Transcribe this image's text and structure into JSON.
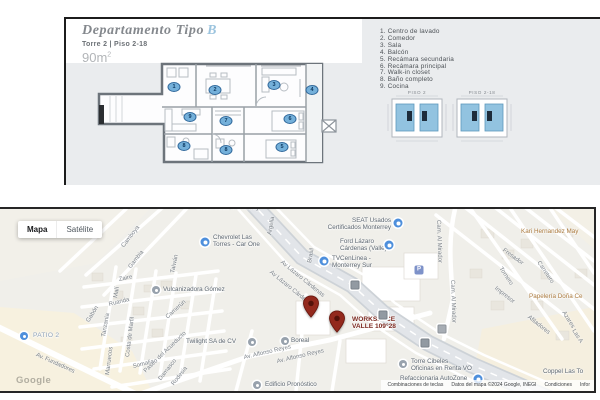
{
  "floorplan": {
    "title": "Departamento Tipo",
    "title_accent": "B",
    "subtitle": "Torre 2 | Piso 2-18",
    "area": "90m",
    "area_exp": "2",
    "legend": [
      "1. Centro de lavado",
      "2. Comedor",
      "3. Sala",
      "4. Balcón",
      "5. Recámara secundaria",
      "6. Recámara principal",
      "7. Walk-in closet",
      "8. Baño completo",
      "9. Cocina"
    ],
    "markers": [
      {
        "n": "1",
        "x": 108,
        "y": 68
      },
      {
        "n": "2",
        "x": 149,
        "y": 71
      },
      {
        "n": "3",
        "x": 208,
        "y": 66
      },
      {
        "n": "4",
        "x": 246,
        "y": 71
      },
      {
        "n": "9",
        "x": 124,
        "y": 98
      },
      {
        "n": "8",
        "x": 118,
        "y": 127
      },
      {
        "n": "7",
        "x": 160,
        "y": 102
      },
      {
        "n": "8",
        "x": 160,
        "y": 131
      },
      {
        "n": "6",
        "x": 224,
        "y": 100
      },
      {
        "n": "5",
        "x": 216,
        "y": 128
      }
    ],
    "piso_labels": [
      "PISO 2",
      "PISO 2-18"
    ]
  },
  "map": {
    "controls": [
      {
        "label": "Mapa",
        "active": true
      },
      {
        "label": "Satélite",
        "active": false
      }
    ],
    "watermark": "Google",
    "footer": [
      "Combinaciones de teclas",
      "Datos del mapa ©2024 Google, INEGI",
      "Condiciones",
      "Infor"
    ],
    "streets": [
      {
        "name": "Camboya",
        "x": 123,
        "y": 35,
        "rot": -52
      },
      {
        "name": "Gambia",
        "x": 130,
        "y": 56,
        "rot": -52
      },
      {
        "name": "Taiwán",
        "x": 173,
        "y": 61,
        "rot": -78
      },
      {
        "name": "Argelia",
        "x": 270,
        "y": 23,
        "rot": -80
      },
      {
        "name": "Brasil",
        "x": 310,
        "y": 51,
        "rot": -80
      },
      {
        "name": "Zaire",
        "x": 119,
        "y": 68,
        "rot": -12
      },
      {
        "name": "Malí",
        "x": 116,
        "y": 86,
        "rot": -80
      },
      {
        "name": "Ruanda",
        "x": 109,
        "y": 93,
        "rot": -14
      },
      {
        "name": "Gabón",
        "x": 88,
        "y": 110,
        "rot": -58
      },
      {
        "name": "Tanzania",
        "x": 104,
        "y": 125,
        "rot": -80
      },
      {
        "name": "Camerún",
        "x": 167,
        "y": 106,
        "rot": -42
      },
      {
        "name": "Costa de Marfil",
        "x": 128,
        "y": 145,
        "rot": -83
      },
      {
        "name": "Marruecos",
        "x": 108,
        "y": 163,
        "rot": -83
      },
      {
        "name": "Somalia",
        "x": 133,
        "y": 155,
        "rot": -14
      },
      {
        "name": "Damasco",
        "x": 160,
        "y": 168,
        "rot": -52
      },
      {
        "name": "Rodesia",
        "x": 173,
        "y": 173,
        "rot": -52
      },
      {
        "name": "Paseo del Acueducto",
        "x": 145,
        "y": 160,
        "rot": -44
      },
      {
        "name": "Av. Fundadores",
        "x": 36,
        "y": 143,
        "rot": 24
      },
      {
        "name": "Av. Alfonso Reyes",
        "x": 244,
        "y": 146,
        "rot": -13
      },
      {
        "name": "Av. Alfonso Reyes",
        "x": 277,
        "y": 150,
        "rot": -13
      },
      {
        "name": "Av Lázaro Cárdenas",
        "x": 281,
        "y": 50,
        "rot": 39
      },
      {
        "name": "Av Lázaro Cárdenas",
        "x": 270,
        "y": 60,
        "rot": 39
      },
      {
        "name": "Cam. Al Mirador",
        "x": 438,
        "y": 8,
        "rot": 88
      },
      {
        "name": "Cam. Al Mirador",
        "x": 452,
        "y": 68,
        "rot": 88
      },
      {
        "name": "Fresador",
        "x": 503,
        "y": 38,
        "rot": 36
      },
      {
        "name": "Tornero",
        "x": 500,
        "y": 56,
        "rot": 56
      },
      {
        "name": "Carretero",
        "x": 538,
        "y": 50,
        "rot": 56
      },
      {
        "name": "Impresor",
        "x": 495,
        "y": 76,
        "rot": 38
      },
      {
        "name": "Afiladores",
        "x": 528,
        "y": 105,
        "rot": 38
      },
      {
        "name": "Azares",
        "x": 563,
        "y": 100,
        "rot": 58
      },
      {
        "name": "Las A",
        "x": 573,
        "y": 118,
        "rot": 58
      }
    ],
    "poi_labels": [
      {
        "x": 213,
        "y": 26,
        "cls": "biz",
        "lines": [
          "Chevrolet Las",
          "Torres - Car One"
        ]
      },
      {
        "x": 391,
        "y": 9,
        "cls": "biz",
        "align": "right",
        "lines": [
          "SEAT Usados",
          "Certificados Monterrey"
        ]
      },
      {
        "x": 340,
        "y": 30,
        "cls": "biz",
        "lines": [
          "Ford Lázaro",
          "Cárdenas (Valle)"
        ]
      },
      {
        "x": 332,
        "y": 47,
        "cls": "biz",
        "lines": [
          "TVCenLinea -",
          "Monterrey Sur"
        ]
      },
      {
        "x": 521,
        "y": 20,
        "cls": "shop",
        "lines": [
          "Kari Hernandez May"
        ]
      },
      {
        "x": 529,
        "y": 85,
        "cls": "shop",
        "lines": [
          "Papelería Doña Ce"
        ]
      },
      {
        "x": 163,
        "y": 78,
        "cls": "biz",
        "lines": [
          "Vulcanizadora Gómez"
        ]
      },
      {
        "x": 33,
        "y": 124,
        "cls": "area",
        "lines": [
          "PATIO 2"
        ]
      },
      {
        "x": 186,
        "y": 130,
        "cls": "biz",
        "lines": [
          "Twilight SA de CV"
        ]
      },
      {
        "x": 291,
        "y": 129,
        "cls": "biz",
        "lines": [
          "Boreal"
        ]
      },
      {
        "x": 352,
        "y": 108,
        "cls": "maroon",
        "lines": [
          "WORKSPACE",
          "VALLE 109°28"
        ]
      },
      {
        "x": 411,
        "y": 150,
        "cls": "biz",
        "lines": [
          "Torre Cibeles",
          "Oficinas en Renta VO"
        ]
      },
      {
        "x": 400,
        "y": 167,
        "cls": "biz",
        "lines": [
          "Refaccionaria AutoZone"
        ]
      },
      {
        "x": 265,
        "y": 173,
        "cls": "biz",
        "lines": [
          "Edificio Pronóstico"
        ]
      },
      {
        "x": 543,
        "y": 160,
        "cls": "biz",
        "lines": [
          "Coppel Las To"
        ]
      },
      {
        "x": 196,
        "y": -4,
        "cls": "biz",
        "lines": [
          "Universidad Monterrey"
        ]
      }
    ],
    "icons": [
      {
        "x": 205,
        "y": 33,
        "k": "blue"
      },
      {
        "x": 398,
        "y": 14,
        "k": "blue"
      },
      {
        "x": 389,
        "y": 36,
        "k": "blue"
      },
      {
        "x": 324,
        "y": 52,
        "k": "blue"
      },
      {
        "x": 156,
        "y": 81,
        "k": "gray"
      },
      {
        "x": 24,
        "y": 127,
        "k": "blue-sm"
      },
      {
        "x": 252,
        "y": 133,
        "k": "gray"
      },
      {
        "x": 285,
        "y": 132,
        "k": "gray"
      },
      {
        "x": 403,
        "y": 155,
        "k": "gray"
      },
      {
        "x": 478,
        "y": 170,
        "k": "blue"
      },
      {
        "x": 257,
        "y": 176,
        "k": "gray"
      },
      {
        "x": 419,
        "y": 61,
        "k": "parking",
        "glyph": "P"
      },
      {
        "x": 355,
        "y": 76,
        "k": "shield"
      },
      {
        "x": 383,
        "y": 106,
        "k": "shield"
      },
      {
        "x": 425,
        "y": 134,
        "k": "shield"
      },
      {
        "x": 442,
        "y": 120,
        "k": "gray-sq"
      }
    ],
    "pins": [
      {
        "x": 311,
        "y": 109
      },
      {
        "x": 337,
        "y": 124
      }
    ]
  }
}
